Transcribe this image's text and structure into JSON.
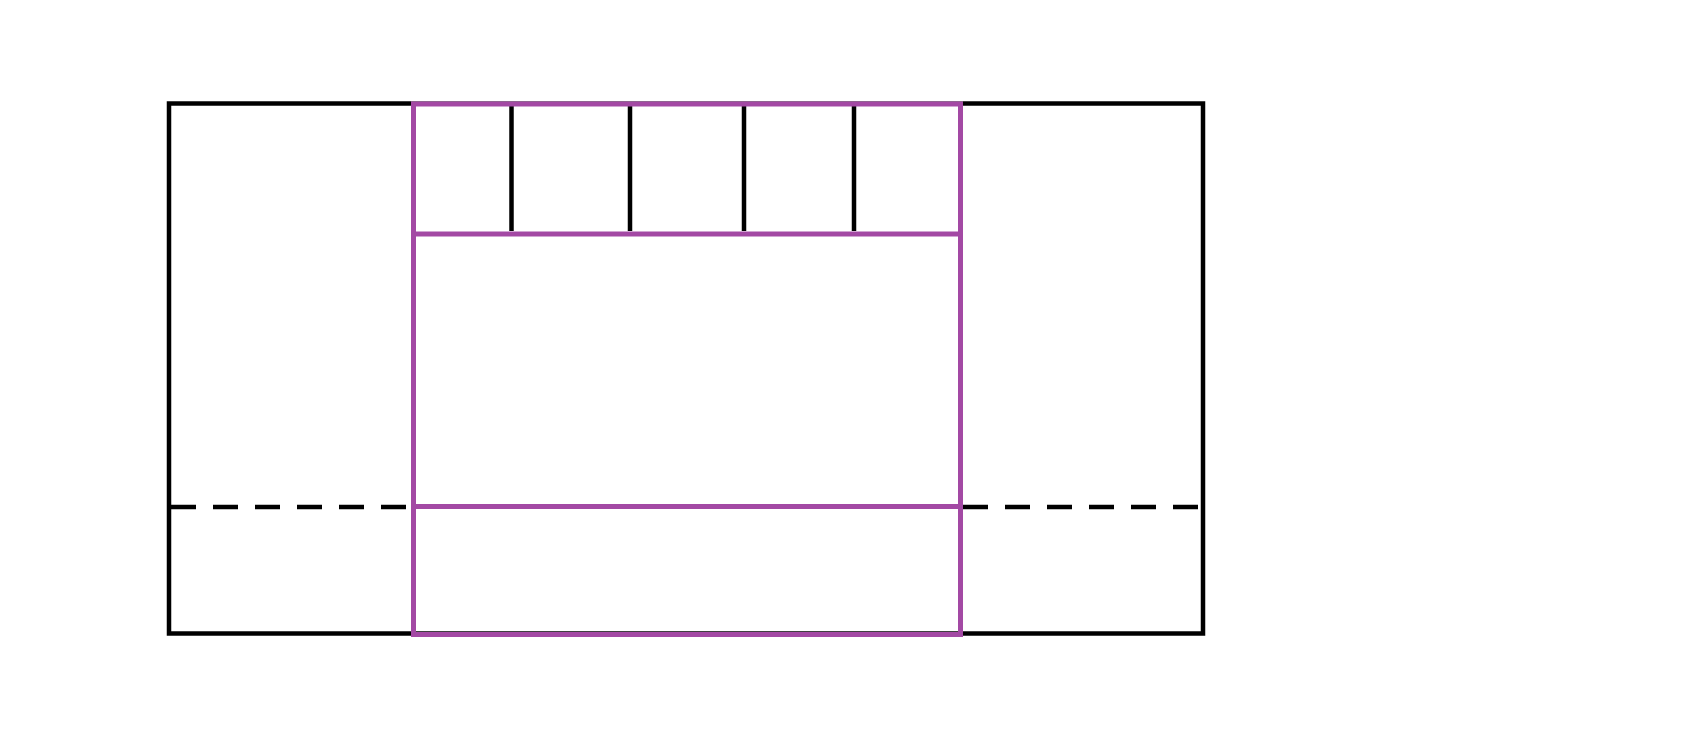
{
  "canvas": {
    "width": 1685,
    "height": 749,
    "background": "#ffffff"
  },
  "palette": {
    "line_black": "#000000",
    "line_purple": "#a349a4"
  },
  "diagram": {
    "outer_rectangle": {
      "x": 169,
      "y": 103.5,
      "width": 1034,
      "height": 530,
      "color_key": "line_black",
      "stroke_width": 4.5
    },
    "inner_rectangle": {
      "x": 413.5,
      "y": 104,
      "width": 547,
      "height": 530.5,
      "color_key": "line_purple",
      "stroke_width": 5
    },
    "divider_lines": [
      {
        "name": "upper-divider-line",
        "x1": 413.5,
        "y1": 234,
        "x2": 960.5,
        "y2": 234,
        "color_key": "line_purple",
        "stroke_width": 5
      },
      {
        "name": "lower-divider-line",
        "x1": 413.5,
        "y1": 506.5,
        "x2": 960.5,
        "y2": 506.5,
        "color_key": "line_purple",
        "stroke_width": 5
      }
    ],
    "tick_lines": [
      {
        "name": "tick-line-1",
        "x": 511.5,
        "y1": 106,
        "y2": 231
      },
      {
        "name": "tick-line-2",
        "x": 630,
        "y1": 106,
        "y2": 231
      },
      {
        "name": "tick-line-3",
        "x": 744,
        "y1": 106,
        "y2": 231
      },
      {
        "name": "tick-line-4",
        "x": 854,
        "y1": 106,
        "y2": 231
      }
    ],
    "tick_style": {
      "color_key": "line_black",
      "stroke_width": 4.5
    },
    "dashed_lines": [
      {
        "name": "left-dashed-line",
        "x1": 171,
        "y1": 507,
        "x2": 411,
        "y2": 507
      },
      {
        "name": "right-dashed-line",
        "x1": 963,
        "y1": 507,
        "x2": 1201,
        "y2": 507
      }
    ],
    "dashed_style": {
      "color_key": "line_black",
      "stroke_width": 4.5,
      "dash_array": "25 17"
    }
  }
}
